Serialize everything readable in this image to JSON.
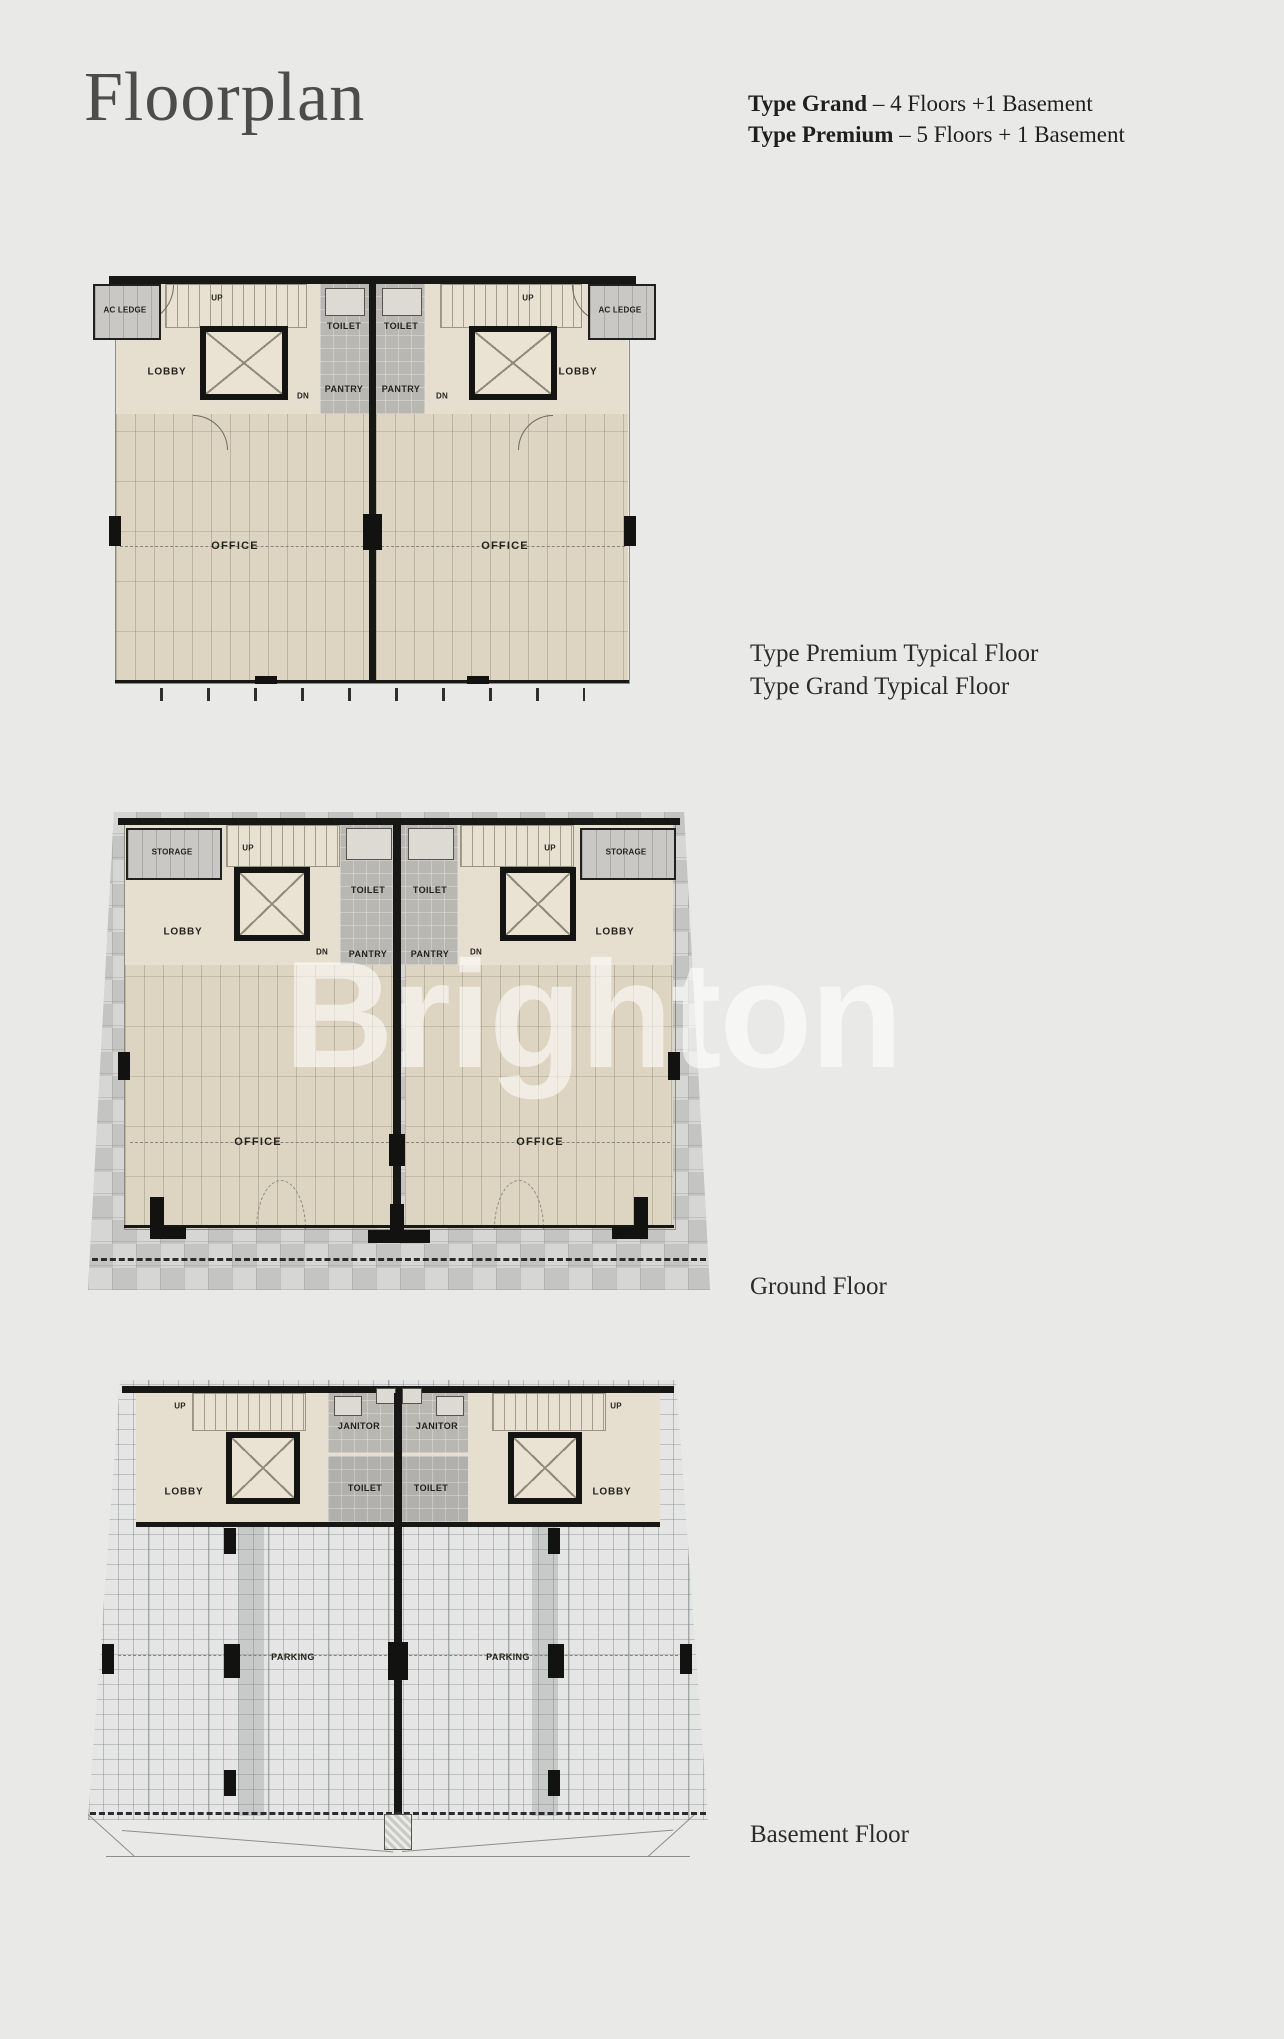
{
  "header": {
    "title": "Floorplan",
    "spec1_bold": "Type Grand",
    "spec1_rest": " – 4 Floors +1 Basement",
    "spec2_bold": "Type Premium",
    "spec2_rest": " – 5 Floors + 1 Basement"
  },
  "watermark": "Brighton",
  "plans": {
    "typical": {
      "caption_line1": "Type Premium Typical Floor",
      "caption_line2": "Type Grand Typical Floor",
      "labels": {
        "ac_ledge": "AC LEDGE",
        "up": "UP",
        "dn": "DN",
        "lobby": "LOBBY",
        "toilet": "TOILET",
        "pantry": "PANTRY",
        "office": "OFFICE"
      }
    },
    "ground": {
      "caption": "Ground Floor",
      "labels": {
        "storage": "STORAGE",
        "up": "UP",
        "dn": "DN",
        "lobby": "LOBBY",
        "toilet": "TOILET",
        "pantry": "PANTRY",
        "office": "OFFICE"
      }
    },
    "basement": {
      "caption": "Basement Floor",
      "labels": {
        "up": "UP",
        "janitor": "JANITOR",
        "lobby": "LOBBY",
        "toilet": "TOILET",
        "parking": "PARKING"
      }
    }
  },
  "colors": {
    "page_bg": "#e9e9e7",
    "plan_cream": "#ddd5c2",
    "wall_black": "#171715",
    "core_gray": "#b8b7b2",
    "paving_gray": "#cdcdcb",
    "watermark_white": "rgba(255,255,255,0.58)",
    "text_dark": "#1f1f1d"
  }
}
